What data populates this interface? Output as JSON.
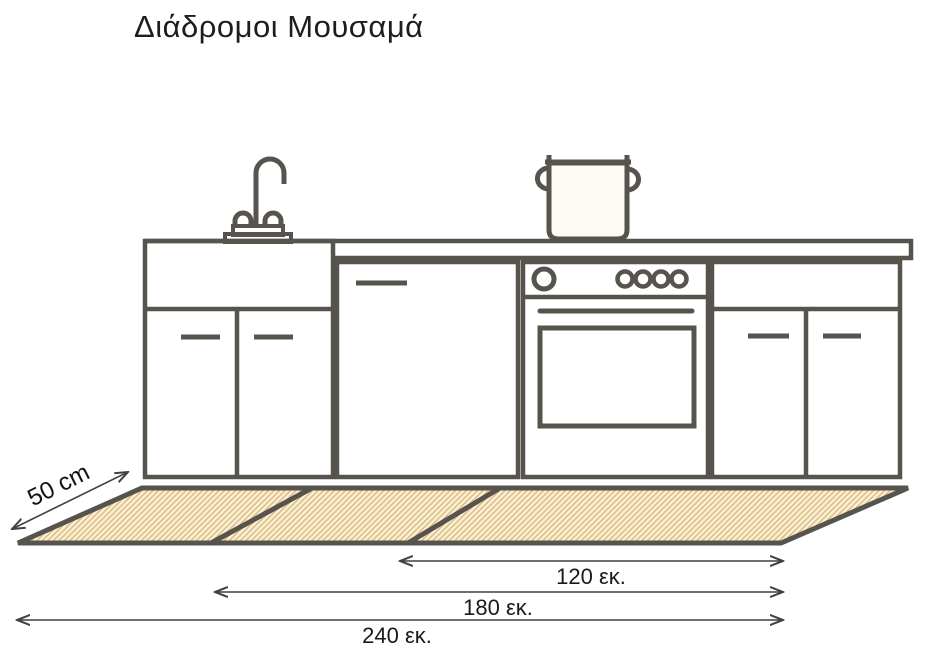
{
  "page": {
    "title": "Διάδρομοι Μουσαμά"
  },
  "diagram": {
    "subject": "kitchen-runner-mat-sizes",
    "mat": {
      "depth_label": "50 cm",
      "length_labels": [
        "120 εκ.",
        "180 εκ.",
        "240 εκ."
      ],
      "fill_color": "#faf3dc",
      "hatch_color": "#e2c088",
      "outline_color": "#57534d"
    },
    "kitchen": {
      "line_color": "#57534d",
      "parts": [
        "faucet-icon",
        "pot-icon",
        "sink-cabinet",
        "dishwasher",
        "oven",
        "right-cabinet",
        "countertop"
      ]
    },
    "dimension_line_color": "#414141",
    "text_color": "#1a1a1a"
  }
}
